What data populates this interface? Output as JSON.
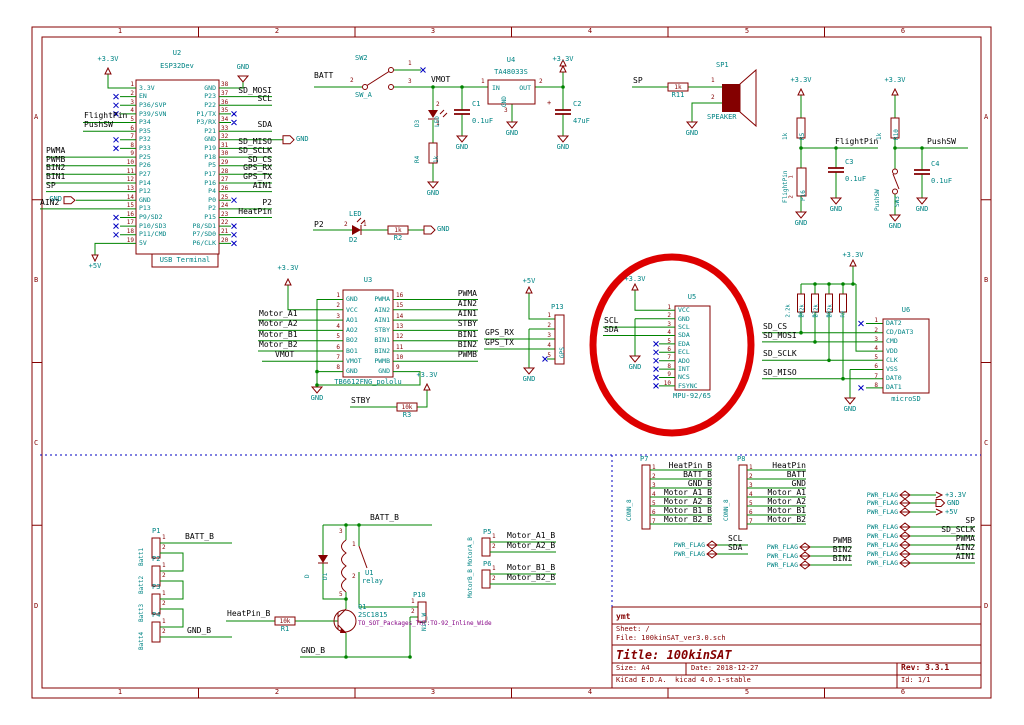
{
  "frame": {
    "cols": [
      "1",
      "2",
      "3",
      "4",
      "5",
      "6"
    ],
    "rows": [
      "A",
      "B",
      "C",
      "D"
    ]
  },
  "power": {
    "p3v3": "+3.3V",
    "p5v": "+5V",
    "gnd": "GND",
    "plus": "+"
  },
  "common": {
    "pins": [
      "1",
      "2",
      "3"
    ]
  },
  "nets": {
    "vmot": "VMOT",
    "batt": "BATT",
    "sp": "SP",
    "flightpin": "FlightPin",
    "pushsw": "PushSW",
    "pwma": "PWMA",
    "pwmb": "PWMB",
    "bin1": "BIN1",
    "bin2": "BIN2",
    "ain1": "AIN1",
    "ain2": "AIN2",
    "scl": "SCL",
    "sda": "SDA",
    "sd_mosi": "SD_MOSI",
    "sd_miso": "SD_MISO",
    "sd_sclk": "SD_SCLK",
    "sd_cs": "SD_CS",
    "gps_rx": "GPS_RX",
    "gps_tx": "GPS_TX",
    "heatpin": "HeatPin",
    "p2": "P2",
    "stby": "STBY",
    "batt_b": "BATT_B",
    "gnd_b": "GND_B",
    "heatpin_b": "HeatPin_B",
    "motor_a1_b": "Motor_A1_B",
    "motor_a2_b": "Motor_A2_B",
    "motor_b1_b": "Motor_B1_B",
    "motor_b2_b": "Motor_B2_B",
    "pwr_flag": "PWR_FLAG"
  },
  "u2": {
    "ref": "U2",
    "value": "ESP32Dev",
    "sub": "USB Terminal",
    "left_nums": [
      "1",
      "2",
      "3",
      "4",
      "5",
      "6",
      "7",
      "8",
      "9",
      "10",
      "11",
      "12",
      "13",
      "14",
      "15",
      "16",
      "17",
      "18",
      "19"
    ],
    "left_names": [
      "3.3V",
      "EN",
      "P36/SVP",
      "P39/SVN",
      "P34",
      "P35",
      "P32",
      "P33",
      "P25",
      "P26",
      "P27",
      "P14",
      "P12",
      "GND",
      "P13",
      "P9/SD2",
      "P10/SD3",
      "P11/CMD",
      "5V"
    ],
    "right_nums": [
      "38",
      "37",
      "36",
      "35",
      "34",
      "33",
      "32",
      "31",
      "30",
      "29",
      "28",
      "27",
      "26",
      "25",
      "24",
      "23",
      "22",
      "21",
      "20"
    ],
    "right_names": [
      "GND",
      "P23",
      "P22",
      "P1/TX",
      "P3/RX",
      "P21",
      "GND",
      "P19",
      "P18",
      "P5",
      "P17",
      "P16",
      "P4",
      "P0",
      "P2",
      "P15",
      "P8/SD1",
      "P7/SD0",
      "P6/CLK"
    ]
  },
  "u3": {
    "ref": "U3",
    "value": "TB6612FNG_pololu",
    "left_nums": [
      "1",
      "2",
      "3",
      "4",
      "5",
      "6",
      "7",
      "8"
    ],
    "left_names": [
      "GND",
      "VCC",
      "AO1",
      "AO2",
      "BO2",
      "BO1",
      "VMOT",
      "GND"
    ],
    "right_nums": [
      "16",
      "15",
      "14",
      "13",
      "12",
      "11",
      "10",
      "9"
    ],
    "right_names": [
      "PWMA",
      "AIN2",
      "AIN1",
      "STBY",
      "BIN1",
      "BIN2",
      "PWMB",
      "GND"
    ]
  },
  "u4": {
    "ref": "U4",
    "value": "TA48033S",
    "pin_in": "IN",
    "pin_out": "OUT",
    "pin_gnd": "GND",
    "nums": [
      "1",
      "2",
      "3"
    ]
  },
  "u5": {
    "ref": "U5",
    "value": "MPU-92/65",
    "nums": [
      "1",
      "2",
      "3",
      "4",
      "5",
      "6",
      "7",
      "8",
      "9",
      "10"
    ],
    "names": [
      "VCC",
      "GND",
      "SCL",
      "SDA",
      "EDA",
      "ECL",
      "ADO",
      "INT",
      "NCS",
      "FSYNC"
    ]
  },
  "u6": {
    "ref": "U6",
    "value": "microSD",
    "nums": [
      "1",
      "2",
      "3",
      "4",
      "5",
      "6",
      "7",
      "8"
    ],
    "names": [
      "DAT2",
      "CD/DAT3",
      "CMD",
      "VDD",
      "CLK",
      "VSS",
      "DAT0",
      "DAT1"
    ]
  },
  "u1": {
    "ref": "U1",
    "value": "relay",
    "coil_a": "3",
    "coil_b": "5",
    "sw_a": "1",
    "sw_b": "2"
  },
  "q1": {
    "ref": "Q1",
    "value": "2SC1815",
    "footprint": "TO_SOT_Packages_THT:TO-92_Inline_Wide"
  },
  "d1": {
    "ref": "D1",
    "value": "D"
  },
  "d2": {
    "ref": "D2",
    "value": "LED"
  },
  "d3": {
    "ref": "D3",
    "value": "LED"
  },
  "sw2": {
    "ref": "SW2",
    "value": "SW_A"
  },
  "sw3": {
    "ref": "SW3",
    "value": "PushSW"
  },
  "sp1": {
    "ref": "SP1",
    "value": "SPEAKER"
  },
  "r": {
    "r1": {
      "ref": "R1",
      "value": "10k"
    },
    "r2": {
      "ref": "R2",
      "value": "1k"
    },
    "r3": {
      "ref": "R3",
      "value": "10k"
    },
    "r4": {
      "ref": "R4",
      "value": "1k"
    },
    "r5": {
      "ref": "R5",
      "value": "1k"
    },
    "r6": {
      "ref": "R6",
      "value": "2.2k"
    },
    "r7": {
      "ref": "R7",
      "value": "2.2k"
    },
    "r8": {
      "ref": "R8",
      "value": "2.2k"
    },
    "r9": {
      "ref": "R9",
      "value": "2.2k"
    },
    "r10": {
      "ref": "R10",
      "value": "1k"
    },
    "r11": {
      "ref": "R11",
      "value": "1k"
    }
  },
  "cap": {
    "c1": {
      "ref": "C1",
      "value": "0.1uF"
    },
    "c2": {
      "ref": "C2",
      "value": "47uF"
    },
    "c3": {
      "ref": "C3",
      "value": "0.1uF"
    },
    "c4": {
      "ref": "C4",
      "value": "0.1uF"
    }
  },
  "conn": {
    "p1": {
      "ref": "P1",
      "value": "Batt1"
    },
    "p2": {
      "ref": "P2",
      "value": "Batt2"
    },
    "p3": {
      "ref": "P3",
      "value": "Batt3"
    },
    "p4": {
      "ref": "P4",
      "value": "Batt4"
    },
    "p5": {
      "ref": "P5",
      "value": "MotorA_B"
    },
    "p6": {
      "ref": "P6",
      "value": "MotorB_B"
    },
    "p7": {
      "ref": "P7",
      "value": "CONN_8",
      "nums": [
        "1",
        "2",
        "3",
        "4",
        "5",
        "6",
        "7"
      ],
      "nets": [
        "HeatPin_B",
        "BATT_B",
        "GND_B",
        "Motor_A1_B",
        "Motor_A2_B",
        "Motor_B1_B",
        "Motor_B2_B"
      ]
    },
    "p8": {
      "ref": "P8",
      "value": "CONN_8",
      "nums": [
        "1",
        "2",
        "3",
        "4",
        "5",
        "6",
        "7"
      ],
      "nets": [
        "HeatPin",
        "BATT",
        "GND",
        "Motor_A1",
        "Motor_A2",
        "Motor_B1",
        "Motor_B2"
      ]
    },
    "p10": {
      "ref": "P10",
      "value": "NiC_W"
    },
    "p13": {
      "ref": "P13",
      "value": "GPS",
      "nums": [
        "1",
        "2",
        "3",
        "4",
        "5"
      ]
    },
    "p16": {
      "ref": "P16",
      "value": "FlightPin"
    }
  },
  "title_block": {
    "comment": "ymt",
    "sheet": "Sheet: /",
    "file": "File: 100kinSAT_ver3.0.sch",
    "title": "Title: 100kinSAT",
    "size": "Size: A4",
    "date": "Date: 2018-12-27",
    "rev": "Rev: 3.3.1",
    "kicad": "KiCad E.D.A.  kicad 4.0.1-stable",
    "id": "Id: 1/1"
  }
}
